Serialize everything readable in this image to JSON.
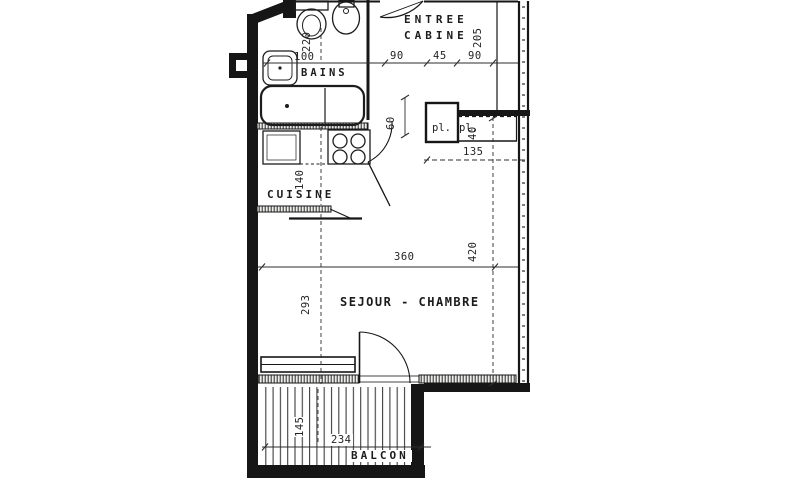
{
  "colors": {
    "ink": "#1c1c1c",
    "paper": "#ffffff",
    "dim_ink": "#242424"
  },
  "labels": {
    "entree_line1": "ENTREE",
    "entree_line2": "CABINE",
    "bains": "BAINS",
    "cuisine": "CUISINE",
    "sejour": "SEJOUR - CHAMBRE",
    "balcon": "BALCON",
    "closet_left": "pl.",
    "closet_right": "pl."
  },
  "dimensions": {
    "wc_width": "220",
    "bains_width": "100",
    "entree_seg1": "90",
    "entree_seg2": "45",
    "entree_seg3": "90",
    "entree_depth": "205",
    "closet_depth": "60",
    "closet_right_depth": "40",
    "closet_width": "135",
    "cuisine_depth": "140",
    "sejour_width": "360",
    "sejour_depth": "420",
    "sejour_left_depth": "293",
    "balcon_depth": "145",
    "balcon_width": "234"
  }
}
